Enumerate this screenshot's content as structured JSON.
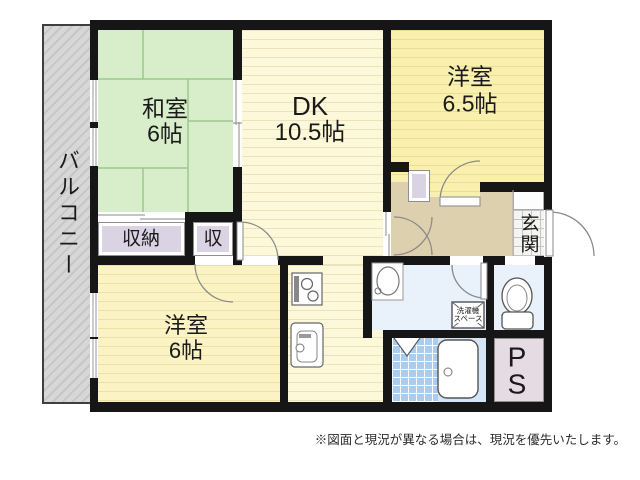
{
  "floorplan": {
    "balcony": {
      "label": "バルコニー"
    },
    "rooms": {
      "washitsu": {
        "name": "和室",
        "size": "6帖"
      },
      "dk": {
        "name": "DK",
        "size": "10.5帖"
      },
      "western_65": {
        "name": "洋室",
        "size": "6.5帖"
      },
      "western_6": {
        "name": "洋室",
        "size": "6帖"
      },
      "closet": {
        "label": "収納"
      },
      "closet_small": {
        "label": "収"
      },
      "genkan": {
        "label": "玄関"
      },
      "pipe_space": {
        "label": "PS"
      },
      "laundry": {
        "line1": "洗濯機",
        "line2": "スペース"
      }
    },
    "note": "※図面と現況が異なる場合は、現況を優先いたします。",
    "colors": {
      "wall": "#161616",
      "tatami_floor": "#d8edca",
      "tatami_line": "#9cc88c",
      "dk_floor": "#fdf8da",
      "dk_stripe": "#ece3bb",
      "western65_floor": "#faf0ae",
      "western65_stripe": "#eadd96",
      "western6_floor": "#fbf3c3",
      "western6_stripe": "#ebe0a6",
      "closet": "#dad3e4",
      "ps_color": "#e5dce3",
      "hallway": "#ddd0ae",
      "washroom": "#e9f1fb",
      "bath_tile": "#a9cdef",
      "bath_floor": "#d3e5f6",
      "balcony_base": "#d7d7d7",
      "balcony_hatch": "#c6c6c6"
    }
  }
}
